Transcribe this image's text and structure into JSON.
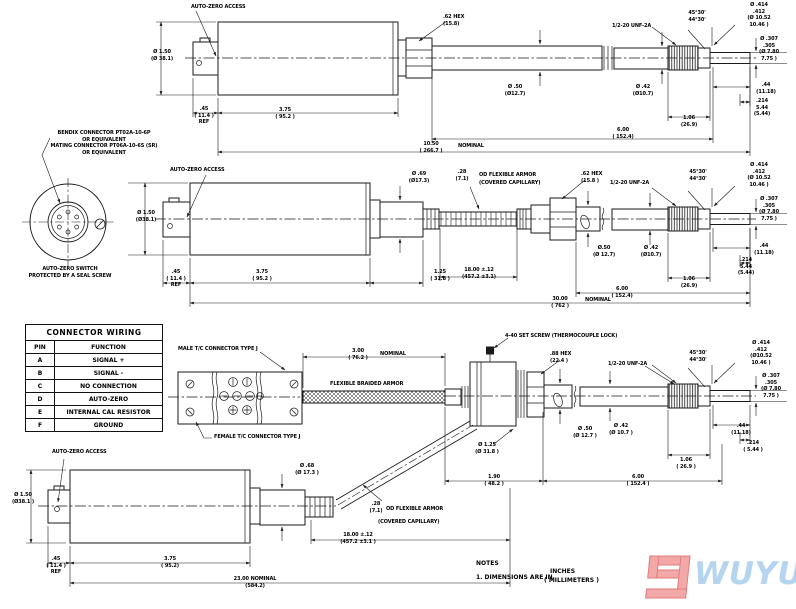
{
  "v1": {
    "auto": "AUTO-ZERO ACCESS",
    "dia150": "Ø 1.50\n(Ø 38.1)",
    "d45": ".45\n( 11.4 )\nREF",
    "d375": "3.75\n( 95.2 )",
    "hex": ".62 HEX\n(15.8)",
    "dia50": "Ø .50\n(Ø12.7)",
    "dia42": "Ø .42\n(Ø10.7)",
    "unf": "1/2-20 UNF-2A",
    "angle": "45°30'\n44°30'",
    "dia414": "Ø .414\n.412\n(Ø 10.52\n10.46 )",
    "dia307": "Ø .307\n.305\n(Ø 7.80\n7.75 )",
    "d44": ".44\n(11.18)",
    "d214": ".214\n5.44\n(5.44)",
    "d106": "1.06\n(26.9)",
    "d600": "6.00\n( 152.4)",
    "d1050": "10.50\n( 266.7 )",
    "nom": "NOMINAL"
  },
  "v2": {
    "auto": "AUTO-ZERO ACCESS",
    "dia150": "Ø 1.50\n(Ø38.1)",
    "d45": ".45\n( 11.4 )\nREF",
    "d375": "3.75\n( 95.2 )",
    "d125": "1.25\n( 31.8 )",
    "d1800": "18.00 ±.12\n(457.2 ±3.1)",
    "d3000": "30.00\n( 762 )",
    "nom": "NOMINAL",
    "dia69": "Ø .69\n(Ø17.3)",
    "d28": ".28\n(7.1)",
    "armor1": "OD FLEXIBLE ARMOR",
    "armor2": "(COVERED CAPILLARY)",
    "hex": ".62 HEX\n(15.8 )",
    "unf": "1/2-20 UNF-2A",
    "angle": "45°30'\n44°30'",
    "dia414": "Ø .414\n.412\n(Ø 10.52\n10.46 )",
    "dia307": "Ø .307\n.305\n(Ø 7.80\n7.75 )",
    "dia50": "Ø.50\n(Ø 12.7)",
    "dia42": "Ø .42\n(Ø10.7)",
    "d44": ".44\n(11.18)",
    "d214": ".214\n5.44\n(5.44)",
    "d106": "1.06\n(26.9)",
    "d600": "6.00\n( 152.4)"
  },
  "v3": {
    "male": "MALE T/C CONNECTOR TYPE J",
    "female": "FEMALE T/C CONNECTOR TYPE J",
    "d300": "3.00\n( 76.2 )",
    "nom": "NOMINAL",
    "braid": "FLEXIBLE BRAIDED ARMOR",
    "screw": "4-40 SET SCREW (THERMOCOUPLE LOCK)",
    "hex": ".88 HEX\n(22.4 )",
    "unf": "1/2-20 UNF-2A",
    "angle": "45°30'\n44°30'",
    "dia414": "Ø .414\n.412\n(Ø10.52\n10.46 )",
    "dia307": "Ø .307\n.305\n(Ø 7.80\n7.75 )",
    "dia50": "Ø .50\n(Ø 12.7 )",
    "dia42": "Ø .42\n(Ø 10.7 )",
    "dia125": "Ø 1.25\n(Ø 31.8 )",
    "d44": ".44\n(11.18)",
    "d214": ".214\n( 5.44 )",
    "d106": "1.06\n( 26.9 )",
    "d190": "1.90\n( 48.2 )",
    "d600": "6.00\n( 152.4 )"
  },
  "v4": {
    "auto": "AUTO-ZERO ACCESS",
    "dia150": "Ø 1.50\n(Ø38.1 )",
    "d45": ".45\n( 11.4 )\nREF",
    "d375": "3.75\n( 95.2)",
    "d2300": "23.00  NOMINAL\n(584.2)",
    "d1800": "18.00 ±.12\n(457.2 ±3.1 )",
    "dia68": "Ø .68\n(Ø 17.3 )",
    "d28": ".28\n(7.1)",
    "armor1": "OD FLEXIBLE ARMOR",
    "armor2": "(COVERED CAPILLARY)"
  },
  "bendix": {
    "label": "BENDIX CONNECTOR PT02A-10-6P\nOR EQUIVALENT\nMATING CONNECTOR PT06A-10-6S (SR)\nOR EQUIVALENT",
    "caption": "AUTO-ZERO SWITCH\nPROTECTED BY A SEAL SCREW"
  },
  "table": {
    "title": "CONNECTOR WIRING",
    "headers": [
      "PIN",
      "FUNCTION"
    ],
    "rows": [
      [
        "A",
        "SIGNAL +"
      ],
      [
        "B",
        "SIGNAL -"
      ],
      [
        "C",
        "NO CONNECTION"
      ],
      [
        "D",
        "AUTO-ZERO"
      ],
      [
        "E",
        "INTERNAL CAL RESISTOR"
      ],
      [
        "F",
        "GROUND"
      ]
    ]
  },
  "notes": {
    "title": "NOTES",
    "item": "1. DIMENSIONS ARE IN",
    "inches": "INCHES",
    "mm": "( MILLIMETERS )"
  },
  "logo": {
    "brand": "WUYUE"
  },
  "colors": {
    "line": "#1a1a1a",
    "logo_red": "#f2a8a8",
    "logo_blue": "#b5d4f0"
  }
}
